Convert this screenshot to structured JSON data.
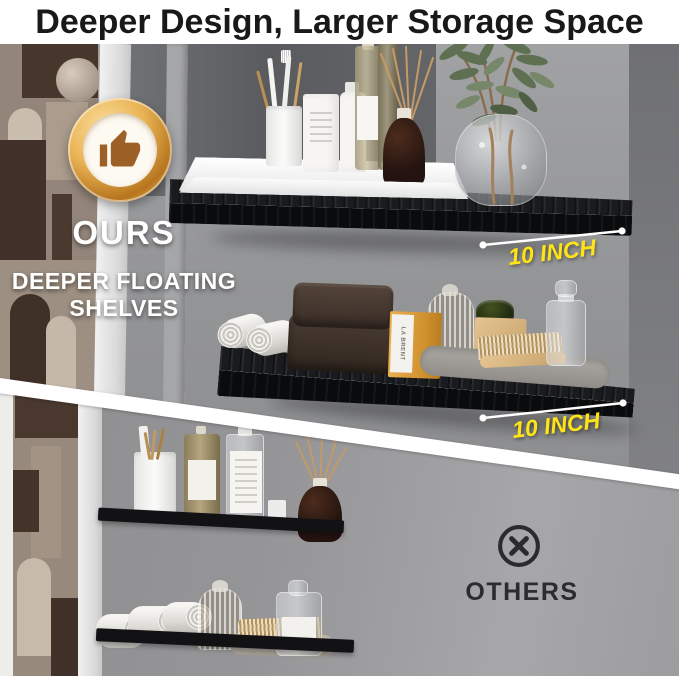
{
  "title": "Deeper Design, Larger Storage Space",
  "ours": {
    "label": "OURS",
    "subline1": "DEEPER FLOATING",
    "subline2": "SHELVES",
    "badge_icon": "thumbs-up",
    "measurements": [
      "10 INCH",
      "10 INCH"
    ]
  },
  "others": {
    "label": "OTHERS",
    "icon": "circle-x"
  },
  "products": {
    "soap_box_label": "LA BRENT"
  },
  "colors": {
    "accent_yellow": "#FFE415",
    "badge_gold": "#D99A33",
    "badge_thumb_brown": "#9D6128",
    "divider_white": "#FFFFFF",
    "shelf_black": "#121214",
    "wall_gray": "#919396",
    "title_text": "#191919",
    "others_text": "#2C2C2E"
  }
}
